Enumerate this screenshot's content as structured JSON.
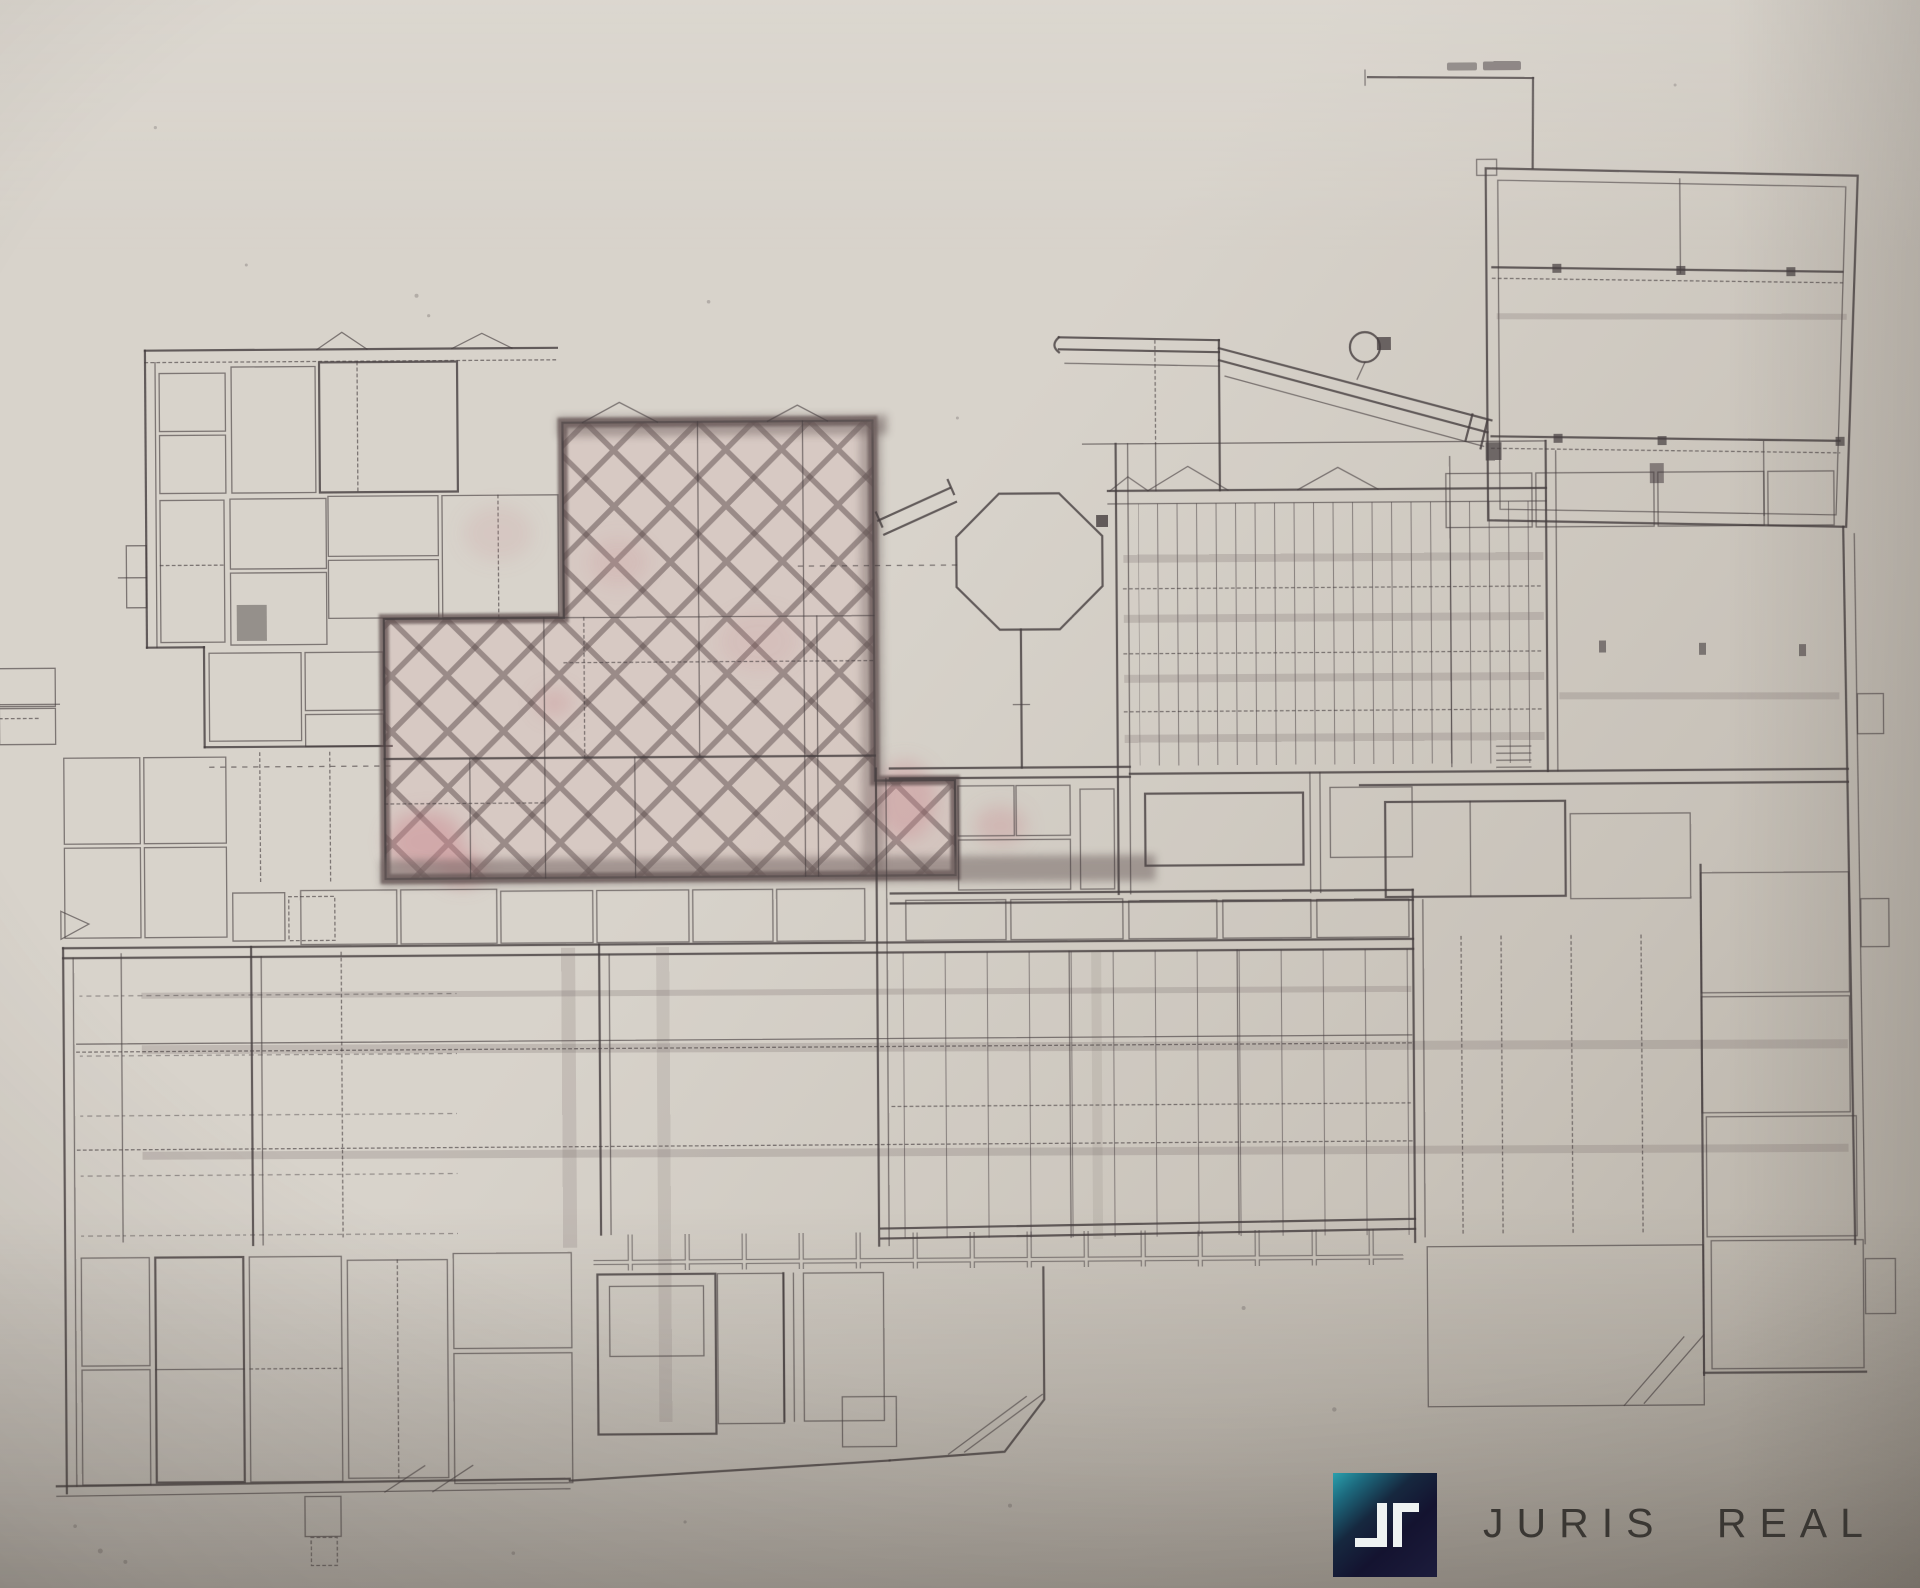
{
  "document": {
    "kind": "scanned floor plan photograph",
    "title": "Building floor plan with highlighted unit"
  },
  "logo": {
    "text": "JURIS REAL",
    "mark": "JR-monogram-square"
  },
  "annotation": {
    "note": "illegible small caption above boundary line (top right)"
  },
  "plan": {
    "highlighted_area_label": "cross-hatched highlighted premises",
    "features": [
      "left wing small rooms",
      "highlighted cross-hatched zone",
      "octagonal column shaft",
      "column grid hall",
      "north wing",
      "access ramp",
      "main production halls",
      "right wing room column",
      "bottom-left room block"
    ]
  },
  "colors": {
    "paper": "#d8d3cb",
    "paper-deep": "#c8c2b9",
    "paper-shadow": "#b3ada3",
    "ink": "#453d3f",
    "marker": "#5d4e4d",
    "smudge": "#6e615e",
    "pink": "#d9a3a6",
    "pink-strong": "#c9838b",
    "logo-navy": "#141330",
    "logo-teal": "#2ba0ad",
    "logo-teal-deep": "#1d6a7e",
    "logo-glyph": "#eef2f2",
    "logo-text": "#3a3733"
  }
}
